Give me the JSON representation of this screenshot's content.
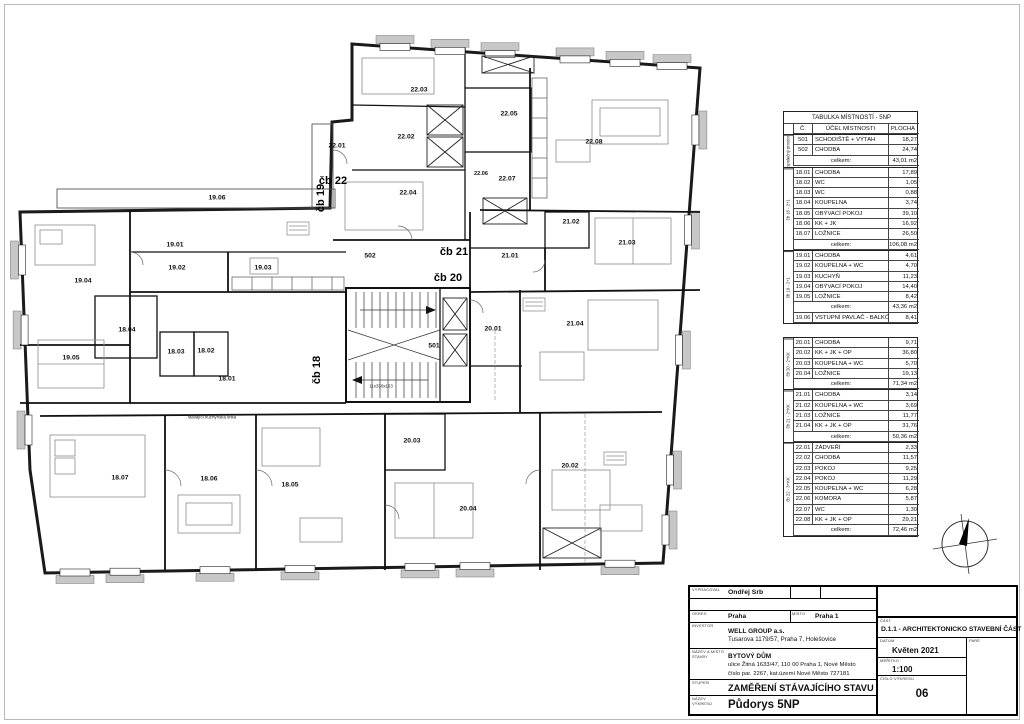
{
  "table": {
    "title": "TABULKA MÍSTNOSTÍ - 5NP",
    "columns": [
      "Č.",
      "ÚČEL MÍSTNOSTI",
      "PLOCHA"
    ],
    "total_label": "celkem:",
    "groups": [
      {
        "label": "společný prostor",
        "rows": [
          [
            "501",
            "SCHODIŠTĚ + VÝTAH",
            "18,27"
          ],
          [
            "502",
            "CHODBA",
            "24,74"
          ]
        ],
        "total": "43,01 m2"
      },
      {
        "label": "čb 18 - 2+1",
        "rows": [
          [
            "18.01",
            "CHODBA",
            "17,89"
          ],
          [
            "18.02",
            "WC",
            "1,05"
          ],
          [
            "18.03",
            "WC",
            "0,88"
          ],
          [
            "18.04",
            "KOUPELNA",
            "3,74"
          ],
          [
            "18.05",
            "OBÝVACÍ POKOJ",
            "39,10"
          ],
          [
            "18.06",
            "KK + JK",
            "16,92"
          ],
          [
            "18.07",
            "LOŽNICE",
            "26,50"
          ]
        ],
        "total": "106,08 m2"
      },
      {
        "label": "čb 19 - 2+1",
        "rows": [
          [
            "19.01",
            "CHODBA",
            "4,61"
          ],
          [
            "19.02",
            "KOUPELNA + WC",
            "4,70"
          ],
          [
            "19.03",
            "KUCHYŇ",
            "11,23"
          ],
          [
            "19.04",
            "OBÝVACÍ POKOJ",
            "14,40"
          ],
          [
            "19.05",
            "LOŽNICE",
            "8,42"
          ]
        ],
        "total": "43,36 m2",
        "extra": [
          [
            "19.06",
            "VSTUPNÍ PAVLAČ - BALKÓN",
            "8,41"
          ]
        ]
      },
      {
        "label": "čb 20 - 2+KK",
        "gap": true,
        "rows": [
          [
            "20.01",
            "CHODBA",
            "9,71"
          ],
          [
            "20.02",
            "KK + JK + OP",
            "36,80"
          ],
          [
            "20.03",
            "KOUPELNA + WC",
            "5,70"
          ],
          [
            "20.04",
            "LOŽNICE",
            "19,13"
          ]
        ],
        "total": "71,34 m2"
      },
      {
        "label": "čb 21 - 2+KK",
        "rows": [
          [
            "21.01",
            "CHODBA",
            "3,14"
          ],
          [
            "21.02",
            "KOUPELNA + WC",
            "3,69"
          ],
          [
            "21.03",
            "LOŽNICE",
            "11,77"
          ],
          [
            "21.04",
            "KK + JK + OP",
            "31,76"
          ]
        ],
        "total": "50,36 m2"
      },
      {
        "label": "čb 22 - 3+KK",
        "rows": [
          [
            "22.01",
            "ZÁDVEŘÍ",
            "2,33"
          ],
          [
            "22.02",
            "CHODBA",
            "11,57"
          ],
          [
            "22.03",
            "POKOJ",
            "9,25"
          ],
          [
            "22.04",
            "POKOJ",
            "11,29"
          ],
          [
            "22.05",
            "KOUPELNA + WC",
            "6,28"
          ],
          [
            "22.06",
            "KOMORA",
            "5,87"
          ],
          [
            "22.07",
            "WC",
            "1,30"
          ],
          [
            "22.08",
            "KK + JK + OP",
            "29,21"
          ]
        ],
        "total": "72,46 m2"
      }
    ]
  },
  "plan": {
    "unit_labels": [
      {
        "text": "čb 22",
        "x": 333,
        "y": 181
      },
      {
        "text": "čb 19",
        "x": 321,
        "y": 198,
        "v": true
      },
      {
        "text": "čb 21",
        "x": 454,
        "y": 252
      },
      {
        "text": "čb 20",
        "x": 448,
        "y": 278
      },
      {
        "text": "čb 18",
        "x": 317,
        "y": 370,
        "v": true
      }
    ],
    "room_labels": [
      {
        "text": "19.06",
        "x": 217,
        "y": 198
      },
      {
        "text": "22.03",
        "x": 419,
        "y": 90
      },
      {
        "text": "22.02",
        "x": 406,
        "y": 137
      },
      {
        "text": "22.01",
        "x": 337,
        "y": 146
      },
      {
        "text": "22.05",
        "x": 509,
        "y": 114
      },
      {
        "text": "22.06",
        "x": 481,
        "y": 174,
        "cls": "s"
      },
      {
        "text": "22.07",
        "x": 507,
        "y": 179
      },
      {
        "text": "22.08",
        "x": 594,
        "y": 142
      },
      {
        "text": "22.04",
        "x": 408,
        "y": 193
      },
      {
        "text": "21.02",
        "x": 571,
        "y": 222
      },
      {
        "text": "21.03",
        "x": 627,
        "y": 243
      },
      {
        "text": "21.01",
        "x": 510,
        "y": 256
      },
      {
        "text": "21.04",
        "x": 575,
        "y": 324
      },
      {
        "text": "502",
        "x": 370,
        "y": 256
      },
      {
        "text": "501",
        "x": 434,
        "y": 346
      },
      {
        "text": "20.01",
        "x": 493,
        "y": 329
      },
      {
        "text": "20.03",
        "x": 412,
        "y": 441
      },
      {
        "text": "20.02",
        "x": 570,
        "y": 466
      },
      {
        "text": "20.04",
        "x": 468,
        "y": 509
      },
      {
        "text": "19.01",
        "x": 175,
        "y": 245
      },
      {
        "text": "19.02",
        "x": 177,
        "y": 268
      },
      {
        "text": "19.03",
        "x": 263,
        "y": 268
      },
      {
        "text": "19.04",
        "x": 83,
        "y": 281
      },
      {
        "text": "19.05",
        "x": 71,
        "y": 358
      },
      {
        "text": "18.04",
        "x": 127,
        "y": 330
      },
      {
        "text": "18.03",
        "x": 176,
        "y": 352
      },
      {
        "text": "18.02",
        "x": 206,
        "y": 351
      },
      {
        "text": "18.01",
        "x": 227,
        "y": 379
      },
      {
        "text": "18.07",
        "x": 120,
        "y": 478
      },
      {
        "text": "18.06",
        "x": 209,
        "y": 479
      },
      {
        "text": "18.05",
        "x": 290,
        "y": 485
      }
    ],
    "notes": [
      {
        "text": "stávající kuchyňská linka",
        "x": 212,
        "y": 417
      },
      {
        "text": "11x330x163",
        "x": 381,
        "y": 386
      }
    ]
  },
  "titleblock": {
    "vypracoval_label": "VYPRACOVAL",
    "vypracoval": "Ondřej Srb",
    "okres_label": "OKRES",
    "okres": "Praha",
    "mesto_label": "MÍSTO",
    "mesto": "Praha 1",
    "investor_label": "INVESTOR",
    "investor_line1": "WELL GROUP a.s.",
    "investor_line2": "Tusarova 1179/57, Praha 7, Holešovice",
    "nazev_label": "NÁZEV A MÍSTO STAVBY",
    "nazev_line1": "BYTOVÝ DŮM",
    "nazev_line2": "ulice Žitná 1633/47, 110 00  Praha 1, Nové Město",
    "nazev_line3": "číslo par. 2267, kat.území Nové Město 727181",
    "stupen_label": "STUPEŇ",
    "stupen": "ZAMĚŘENÍ STÁVAJÍCÍHO STAVU",
    "vykres_label": "NÁZEV VÝKRESU",
    "vykres": "Půdorys 5NP",
    "cast_label": "ČÁST",
    "cast": "D.1.1 - ARCHITEKTONICKO STAVEBNÍ ČÁST",
    "datum_label": "DATUM",
    "datum": "Květen 2021",
    "pare_label": "PARÉ",
    "meritko_label": "MĚŘÍTKO",
    "meritko": "1:100",
    "cislo_label": "ČÍSLO VÝKRESU",
    "cislo": "06"
  }
}
